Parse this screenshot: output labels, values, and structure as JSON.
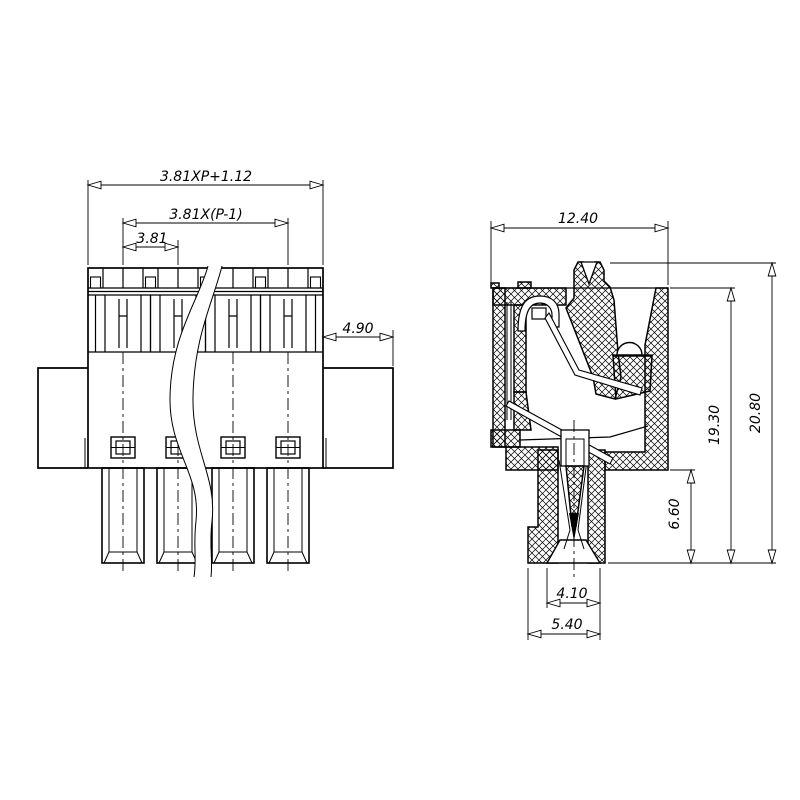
{
  "drawing": {
    "type": "terminal-block-connector-engineering-drawing",
    "colors": {
      "line": "#000000",
      "background": "#ffffff"
    }
  },
  "front_view": {
    "dims": {
      "overall": "3.81XP+1.12",
      "span": "3.81X(P-1)",
      "pitch": "3.81",
      "flange": "4.90"
    }
  },
  "side_view": {
    "dims": {
      "width": "12.40",
      "body_height": "19.30",
      "overall_height": "20.80",
      "plug_length": "6.60",
      "tip_opening": "4.10",
      "tip_base": "5.40"
    }
  }
}
